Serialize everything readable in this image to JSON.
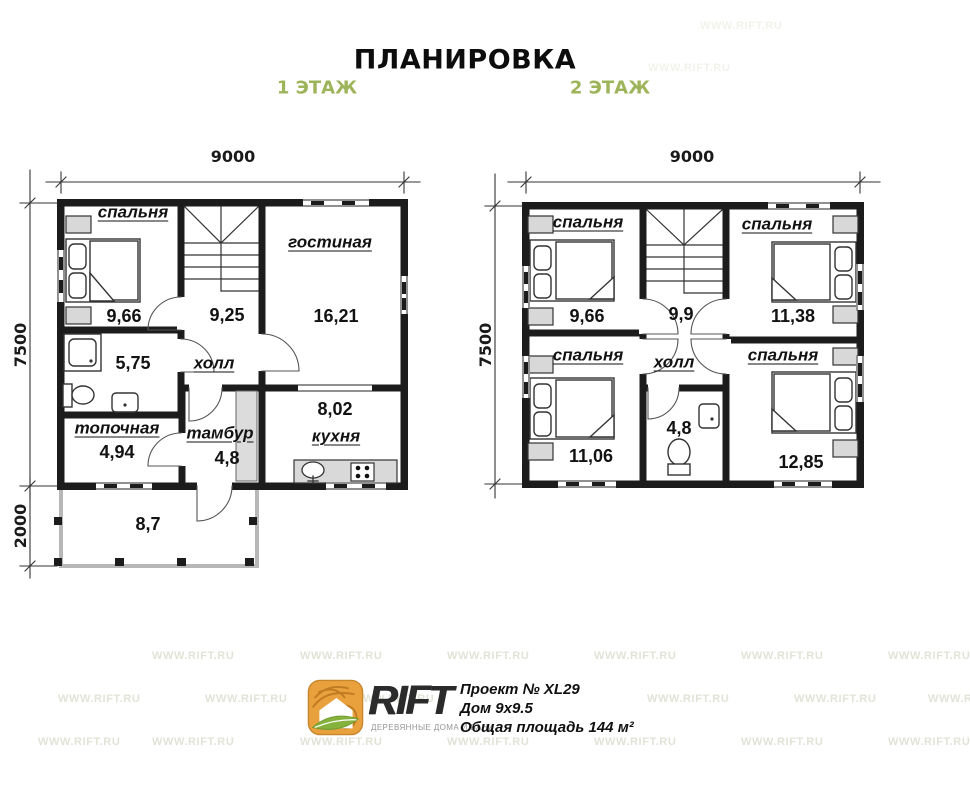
{
  "page": {
    "title": "ПЛАНИРОВКА"
  },
  "floor1": {
    "label": "1 ЭТАЖ",
    "dims": {
      "width": "9000",
      "height": "7500",
      "terrace": "2000"
    },
    "rooms": {
      "bedroom": {
        "name": "спальня",
        "area": "9,66"
      },
      "hall": {
        "name": "холл",
        "area": "9,25"
      },
      "living": {
        "name": "гостиная",
        "area": "16,21"
      },
      "bath": {
        "area": "5,75"
      },
      "boiler": {
        "name": "топочная",
        "area": "4,94"
      },
      "tambour": {
        "name": "тамбур",
        "area": "4,8"
      },
      "kitchen": {
        "name": "кухня",
        "area": "8,02"
      },
      "terrace": {
        "area": "8,7"
      }
    }
  },
  "floor2": {
    "label": "2 ЭТАЖ",
    "dims": {
      "width": "9000",
      "height": "7500"
    },
    "rooms": {
      "bedroom_tl": {
        "name": "спальня",
        "area": "9,66"
      },
      "bedroom_tr": {
        "name": "спальня",
        "area": "11,38"
      },
      "hall": {
        "name": "холл",
        "area": "9,9"
      },
      "bedroom_bl": {
        "name": "спальня",
        "area": "11,06"
      },
      "bedroom_br": {
        "name": "спальня",
        "area": "12,85"
      },
      "bath": {
        "area": "4,8"
      }
    }
  },
  "footer": {
    "brand": "RIFT",
    "tagline": "ДЕРЕВЯННЫЕ ДОМА И БАНИ",
    "project": "Проект № XL29",
    "house": "Дом 9х9.5",
    "total_area": "Общая площадь 144 м²"
  },
  "watermark": {
    "text": "WWW.RIFT.RU"
  },
  "colors": {
    "accent_green": "#9eb45a",
    "wall": "#1c1c1c",
    "furniture_gray": "#d8d8d8",
    "watermark": "#e2e3d7"
  }
}
